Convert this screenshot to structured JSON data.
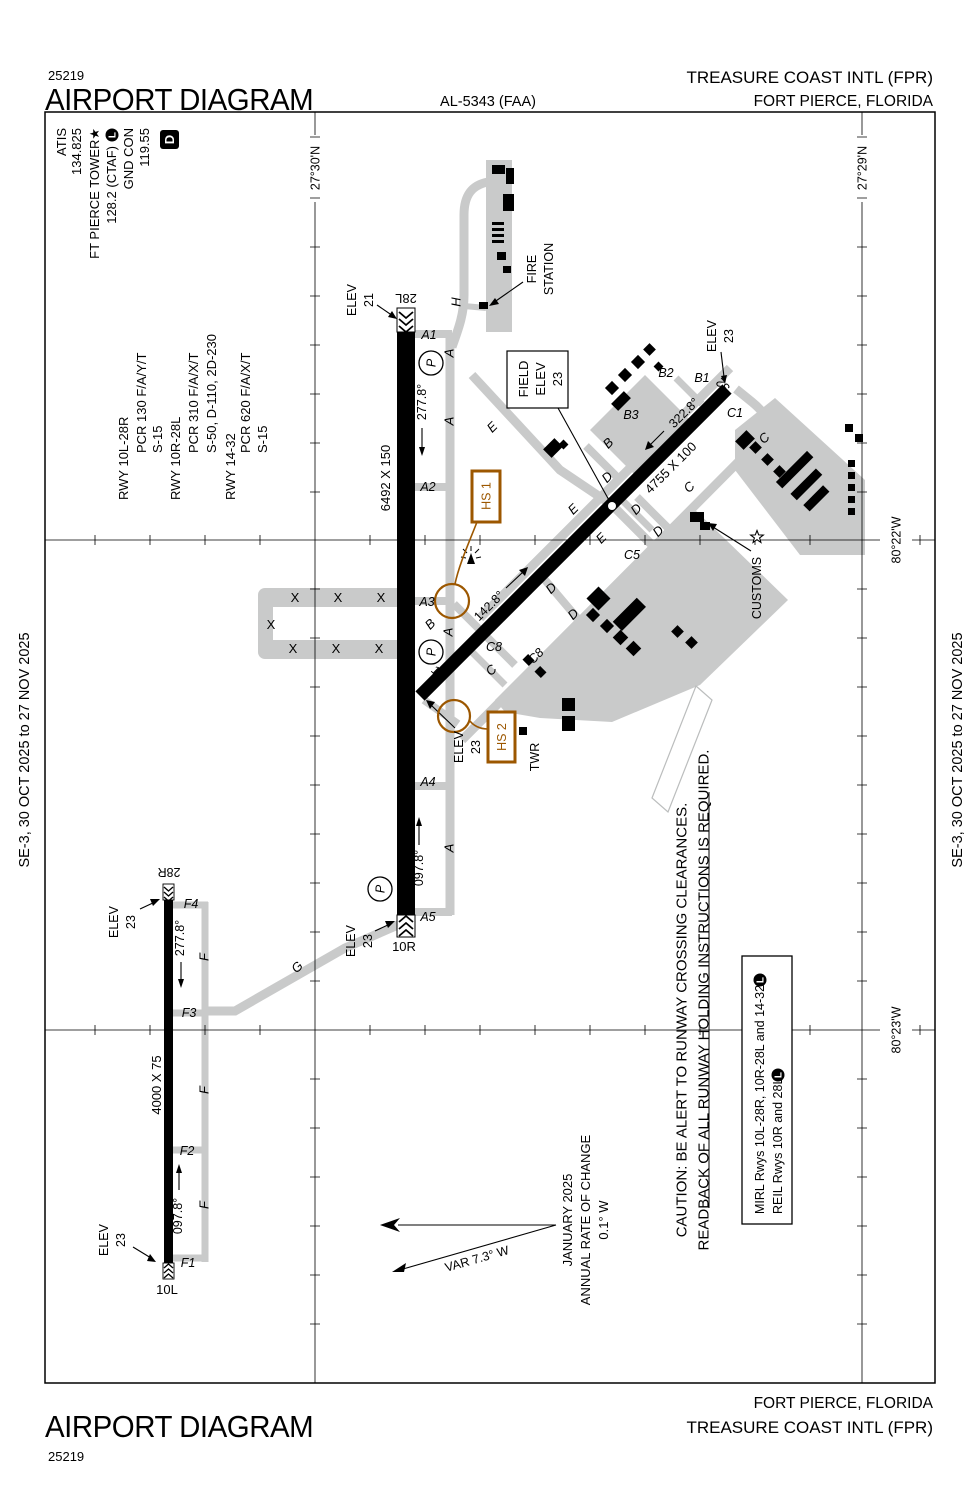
{
  "colors": {
    "hotspot": "#9C5700",
    "taxiway": "#C9CACA",
    "ink": "#000000"
  },
  "header": {
    "chart_code": "25219",
    "title": "AIRPORT DIAGRAM",
    "chart_ref": "AL-5343 (FAA)",
    "airport": "TREASURE COAST INTL (FPR)",
    "city": "FORT PIERCE, FLORIDA"
  },
  "footer": {
    "title": "AIRPORT DIAGRAM",
    "chart_code": "25219",
    "airport": "TREASURE COAST INTL (FPR)",
    "city": "FORT PIERCE, FLORIDA"
  },
  "margin_note": "SE-3,  30 OCT 2025  to  27 NOV 2025",
  "comm": {
    "atis": "ATIS",
    "atis_freq": "134.825",
    "tower": "FT PIERCE TOWER★",
    "tower_freq": "128.2 (CTAF)",
    "signal": "L",
    "gnd": "GND CON",
    "gnd_freq": "119.55",
    "datis": "D"
  },
  "rwy_data": {
    "r1": "RWY 10L-28R",
    "r1_pcr": "PCR 130 F/A/Y/T",
    "r1_s": "S-15",
    "r2": "RWY 10R-28L",
    "r2_pcr": "PCR 310 F/A/X/T",
    "r2_s": "S-50, D-110, 2D-230",
    "r3": "RWY 14-32",
    "r3_pcr": "PCR 620 F/A/X/T",
    "r3_s": "S-15"
  },
  "graticule": {
    "lat1": "27°30'N",
    "lat2": "27°29'N",
    "lon1": "80°22'W",
    "lon2": "80°23'W"
  },
  "field_elev": {
    "l1": "FIELD",
    "l2": "ELEV",
    "val": "23"
  },
  "runways": {
    "main": {
      "dim": "6492 X 150",
      "end_e": "28L",
      "end_w": "10R",
      "hdg_w": "277.8°",
      "hdg_e": "097.8°",
      "elev_label": "ELEV",
      "elev_e": "21",
      "elev_w": "23"
    },
    "small": {
      "dim": "4000 X 75",
      "end_e": "28R",
      "end_w": "10L",
      "hdg_w": "277.8°",
      "hdg_e": "097.8°",
      "elev_label": "ELEV",
      "elev_e": "23",
      "elev_w": "23"
    },
    "diag": {
      "dim": "4755 X 100",
      "end_nw": "14",
      "end_se": "32",
      "hdg_se": "142.8°",
      "hdg_nw": "322.8°",
      "elev_label": "ELEV",
      "elev_nw": "23",
      "elev_se": "23"
    }
  },
  "hotspots": {
    "hs1": "HS 1",
    "hs2": "HS 2"
  },
  "features": {
    "fire_1": "FIRE",
    "fire_2": "STATION",
    "customs": "CUSTOMS",
    "tower": "TWR",
    "parking": "P",
    "closed_mark": "X"
  },
  "taxiways": {
    "a1": "A1",
    "a2": "A2",
    "a3": "A3",
    "a4": "A4",
    "a5": "A5",
    "f1": "F1",
    "f2": "F2",
    "f3": "F3",
    "f4": "F4",
    "b1": "B1",
    "b2": "B2",
    "b3": "B3",
    "c1": "C1",
    "c5": "C5",
    "c8": "C8",
    "a": "A",
    "b": "B",
    "c": "C",
    "d": "D",
    "e": "E",
    "f": "F",
    "g": "G",
    "h": "H"
  },
  "variation": {
    "var": "VAR 7.3°  W",
    "month": "JANUARY 2025",
    "rate1": "ANNUAL RATE OF CHANGE",
    "rate2": "0.1° W"
  },
  "caution": {
    "l1": "CAUTION: BE ALERT TO RUNWAY CROSSING CLEARANCES.",
    "l2": "READBACK OF ALL RUNWAY HOLDING INSTRUCTIONS IS REQUIRED."
  },
  "lighting": {
    "l1": "MIRL Rwys 10L-28R, 10R-28L and 14-32",
    "l2": "REIL Rwys 10R and 28L",
    "signal": "L"
  }
}
